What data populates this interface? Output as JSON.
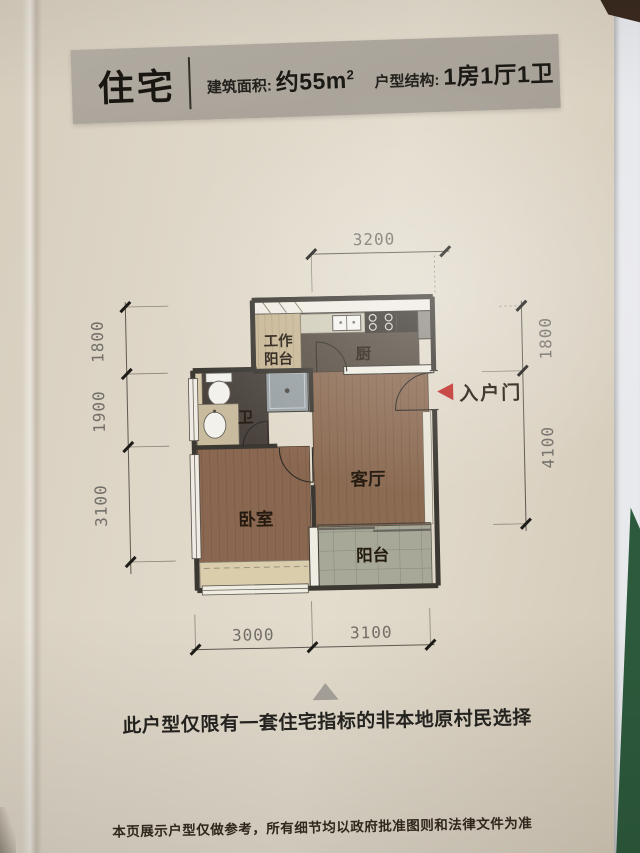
{
  "header": {
    "unit_type": "住宅",
    "area_label": "建筑面积:",
    "area_value": "约55m",
    "area_sup": "2",
    "layout_label": "户型结构:",
    "layout_value": "1房1厅1卫"
  },
  "floorplan": {
    "rooms": {
      "work_balcony_line1": "工作",
      "work_balcony_line2": "阳台",
      "kitchen": "厨",
      "bathroom": "卫",
      "living": "客厅",
      "bedroom": "卧室",
      "balcony": "阳台"
    },
    "entrance": "入户门",
    "dims": {
      "top": "3200",
      "left": [
        "1800",
        "1900",
        "3100"
      ],
      "right": [
        "1800",
        "4100"
      ],
      "bottom": [
        "3000",
        "3100"
      ]
    }
  },
  "note": "此户型仅限有一套住宅指标的非本地原村民选择",
  "footer": "本页展示户型仅做参考，所有细节均以政府批准图则和法律文件为准",
  "colors": {
    "accent_red": "#bf2b28",
    "header_bg": "#aaa49a",
    "page_bg": "#ddd4c5",
    "wall_dark": "#3b3731",
    "wood_floor": "#8c6b53",
    "balcony_tile": "#a7a898",
    "book_edge_green": "#2d5a3c"
  }
}
